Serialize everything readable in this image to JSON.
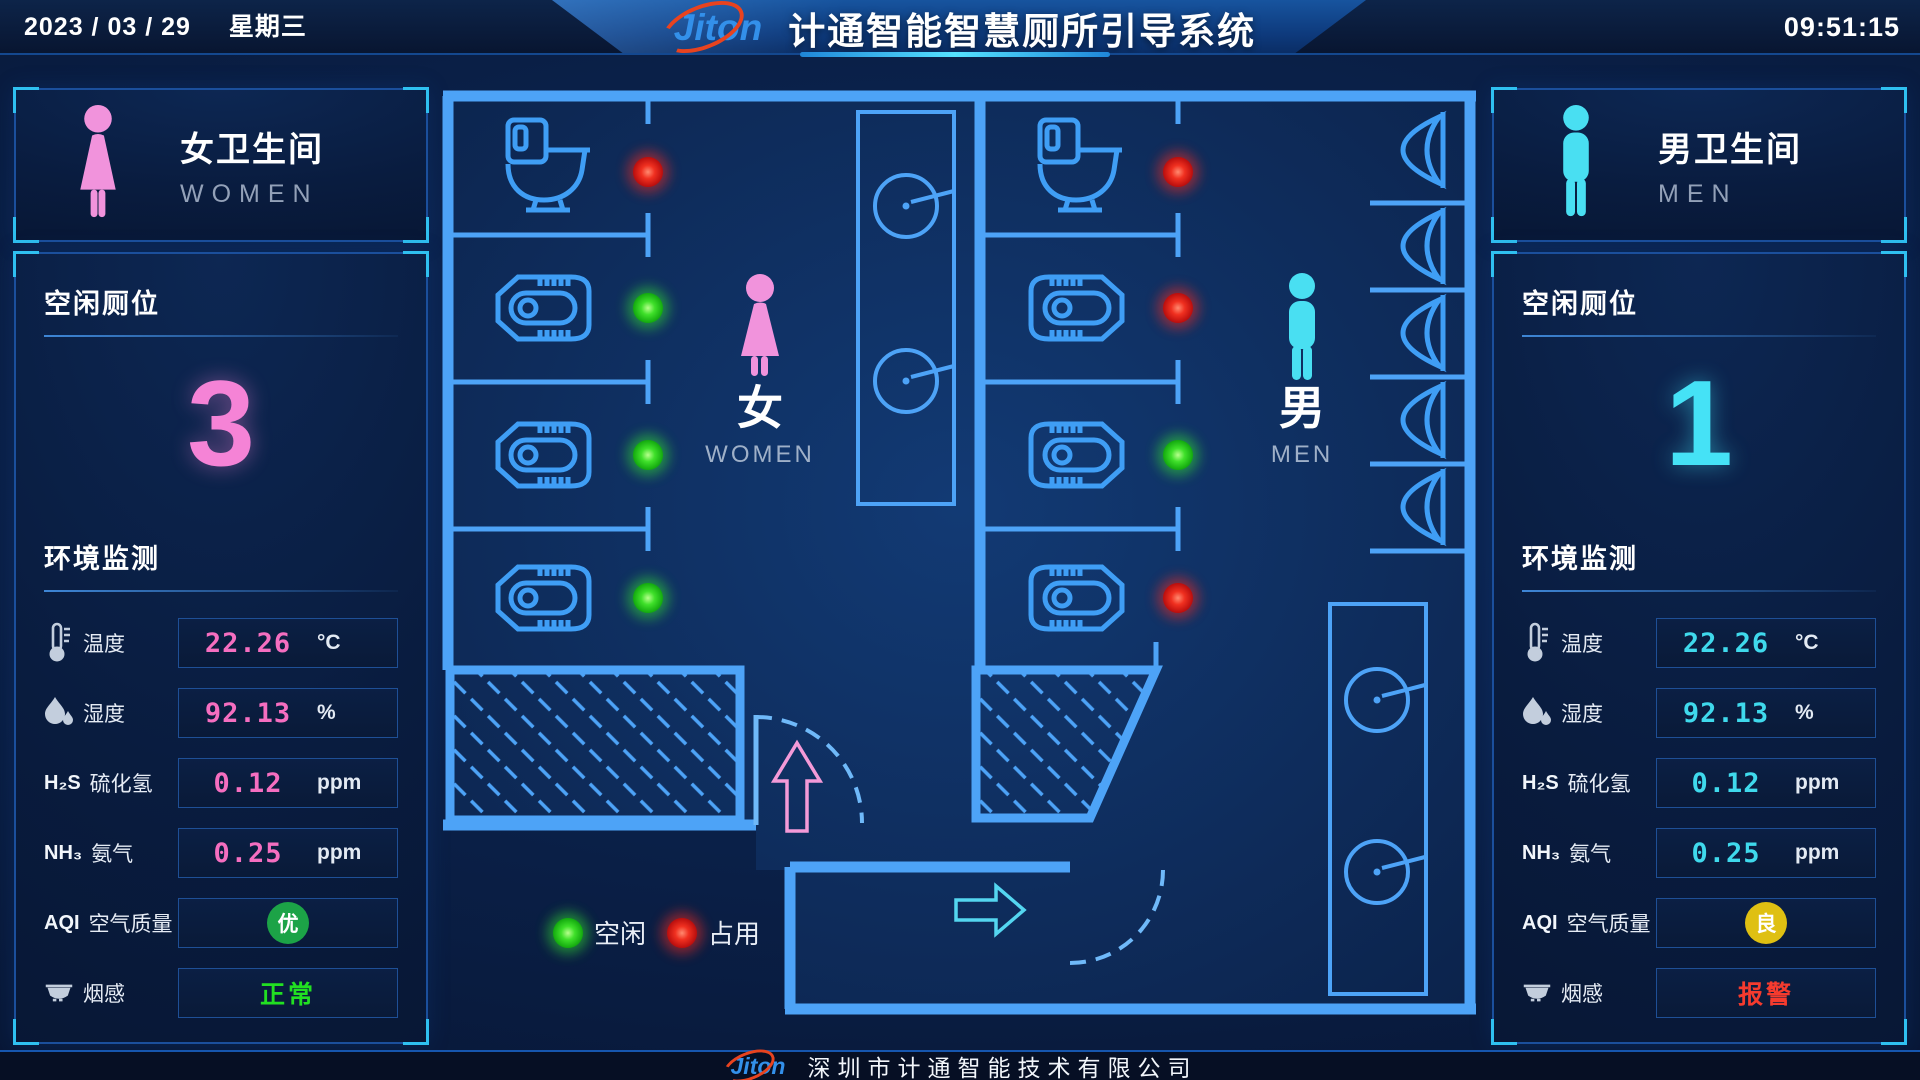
{
  "header": {
    "date": "2023 / 03 / 29",
    "weekday": "星期三",
    "time": "09:51:15",
    "logo": "Jiton",
    "title": "计通智能智慧厕所引导系统"
  },
  "colors": {
    "wall_blue": "#4da3f7",
    "women_pink": "#f193dc",
    "men_cyan": "#49dff2",
    "vacant_green": "#35e82e",
    "occupied_red": "#e81c1c"
  },
  "women_panel": {
    "title": "女卫生间",
    "subtitle": "WOMEN",
    "vacant_title": "空闲厕位",
    "vacant_count": "3",
    "env_title": "环境监测",
    "rows": [
      {
        "icon": "thermometer-icon",
        "label": "温度",
        "value": "22.26",
        "unit": "°C"
      },
      {
        "icon": "humidity-icon",
        "label": "湿度",
        "value": "92.13",
        "unit": "%"
      },
      {
        "prefix": "H₂S",
        "label": "硫化氢",
        "value": "0.12",
        "unit": "ppm"
      },
      {
        "prefix": "NH₃",
        "label": "氨气",
        "value": "0.25",
        "unit": "ppm"
      },
      {
        "prefix": "AQI",
        "label": "空气质量",
        "badge": "优",
        "badge_color": "#1ca347"
      },
      {
        "icon": "smoke-detector-icon",
        "label": "烟感",
        "status": "正常",
        "status_color": "#22e022"
      }
    ]
  },
  "men_panel": {
    "title": "男卫生间",
    "subtitle": "MEN",
    "vacant_title": "空闲厕位",
    "vacant_count": "1",
    "env_title": "环境监测",
    "rows": [
      {
        "icon": "thermometer-icon",
        "label": "温度",
        "value": "22.26",
        "unit": "°C"
      },
      {
        "icon": "humidity-icon",
        "label": "湿度",
        "value": "92.13",
        "unit": "%"
      },
      {
        "prefix": "H₂S",
        "label": "硫化氢",
        "value": "0.12",
        "unit": "ppm"
      },
      {
        "prefix": "NH₃",
        "label": "氨气",
        "value": "0.25",
        "unit": "ppm"
      },
      {
        "prefix": "AQI",
        "label": "空气质量",
        "badge": "良",
        "badge_color": "#dfc012"
      },
      {
        "icon": "smoke-detector-icon",
        "label": "烟感",
        "status": "报警",
        "status_color": "#f53b2e"
      }
    ]
  },
  "floor_plan": {
    "women_zone": {
      "cn": "女",
      "en": "WOMEN",
      "stalls": [
        {
          "type": "toilet",
          "status": "occupied"
        },
        {
          "type": "squat",
          "status": "vacant"
        },
        {
          "type": "squat",
          "status": "vacant"
        },
        {
          "type": "squat",
          "status": "vacant"
        }
      ]
    },
    "men_zone": {
      "cn": "男",
      "en": "MEN",
      "stalls": [
        {
          "type": "toilet",
          "status": "occupied"
        },
        {
          "type": "squat",
          "status": "occupied"
        },
        {
          "type": "squat",
          "status": "vacant"
        },
        {
          "type": "squat",
          "status": "occupied"
        }
      ],
      "urinal_count": 5,
      "sink_count": 2
    },
    "legend": [
      {
        "label": "空闲",
        "status": "vacant"
      },
      {
        "label": "占用",
        "status": "occupied"
      }
    ]
  },
  "footer": {
    "logo": "Jiton",
    "company": "深圳市计通智能技术有限公司"
  }
}
